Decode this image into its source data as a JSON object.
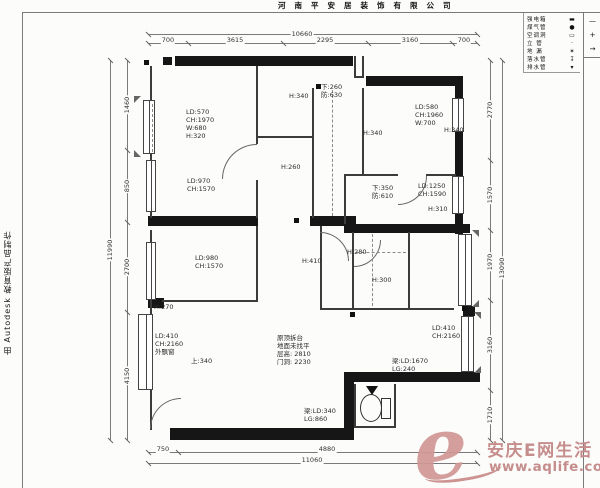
{
  "frame": {
    "title": "河南平安居装饰有限公司",
    "autodesk": "由 Autodesk 教育版产品制作",
    "corner_marks": {
      "m1": "—",
      "m2": "+",
      "m3": "→"
    }
  },
  "legend": {
    "items": [
      {
        "label": "强电箱",
        "symbol": "▬"
      },
      {
        "label": "煤气管",
        "symbol": "●"
      },
      {
        "label": "空调洞",
        "symbol": "▭"
      },
      {
        "label": "立 管",
        "symbol": "·"
      },
      {
        "label": "地 漏",
        "symbol": "✶"
      },
      {
        "label": "落水管",
        "symbol": "↧"
      },
      {
        "label": "排水管",
        "symbol": "▾"
      }
    ]
  },
  "watermark": {
    "logo": "e",
    "name": "安庆E网生活",
    "url": "www.aqlife.com"
  },
  "dims": {
    "top": {
      "total": "10660",
      "segments": [
        "700",
        "3615",
        "2295",
        "3160",
        "700"
      ]
    },
    "left": {
      "total": "11990",
      "segments": [
        "1460",
        "850",
        "2700",
        "4150"
      ]
    },
    "right": {
      "total": "13090",
      "segments": [
        "2770",
        "1570",
        "1970",
        "3160",
        "1710"
      ]
    },
    "bottom": {
      "total": "11060",
      "segments": [
        "750",
        "4880"
      ]
    }
  },
  "plan": {
    "annotations": [
      {
        "text": "LD:570\nCH:1970\nW:680\nH:320"
      },
      {
        "text": "H:340"
      },
      {
        "text": "下:260\n防:630"
      },
      {
        "text": "H:340"
      },
      {
        "text": "LD:580\nCH:1960\nW:700"
      },
      {
        "text": "H:340"
      },
      {
        "text": "LD:970\nCH:1570"
      },
      {
        "text": "H:260"
      },
      {
        "text": "下:350\n防:610"
      },
      {
        "text": "LD:1250\nCH:1590"
      },
      {
        "text": "H:310"
      },
      {
        "text": "H:280"
      },
      {
        "text": "LD:980\nCH:1570"
      },
      {
        "text": "H:410"
      },
      {
        "text": "H:300"
      },
      {
        "text": "H:270"
      },
      {
        "text": "LD:410\nCH:2160\n外飘窗"
      },
      {
        "text": "上:340"
      },
      {
        "text": "原顶拆台\n地面未找平\n层高: 2810\n门洞: 2230"
      },
      {
        "text": "LD:410\nCH:2160"
      },
      {
        "text": "梁:LD:1670\nLG:240"
      },
      {
        "text": "梁:LD:340\nLG:860"
      }
    ]
  }
}
